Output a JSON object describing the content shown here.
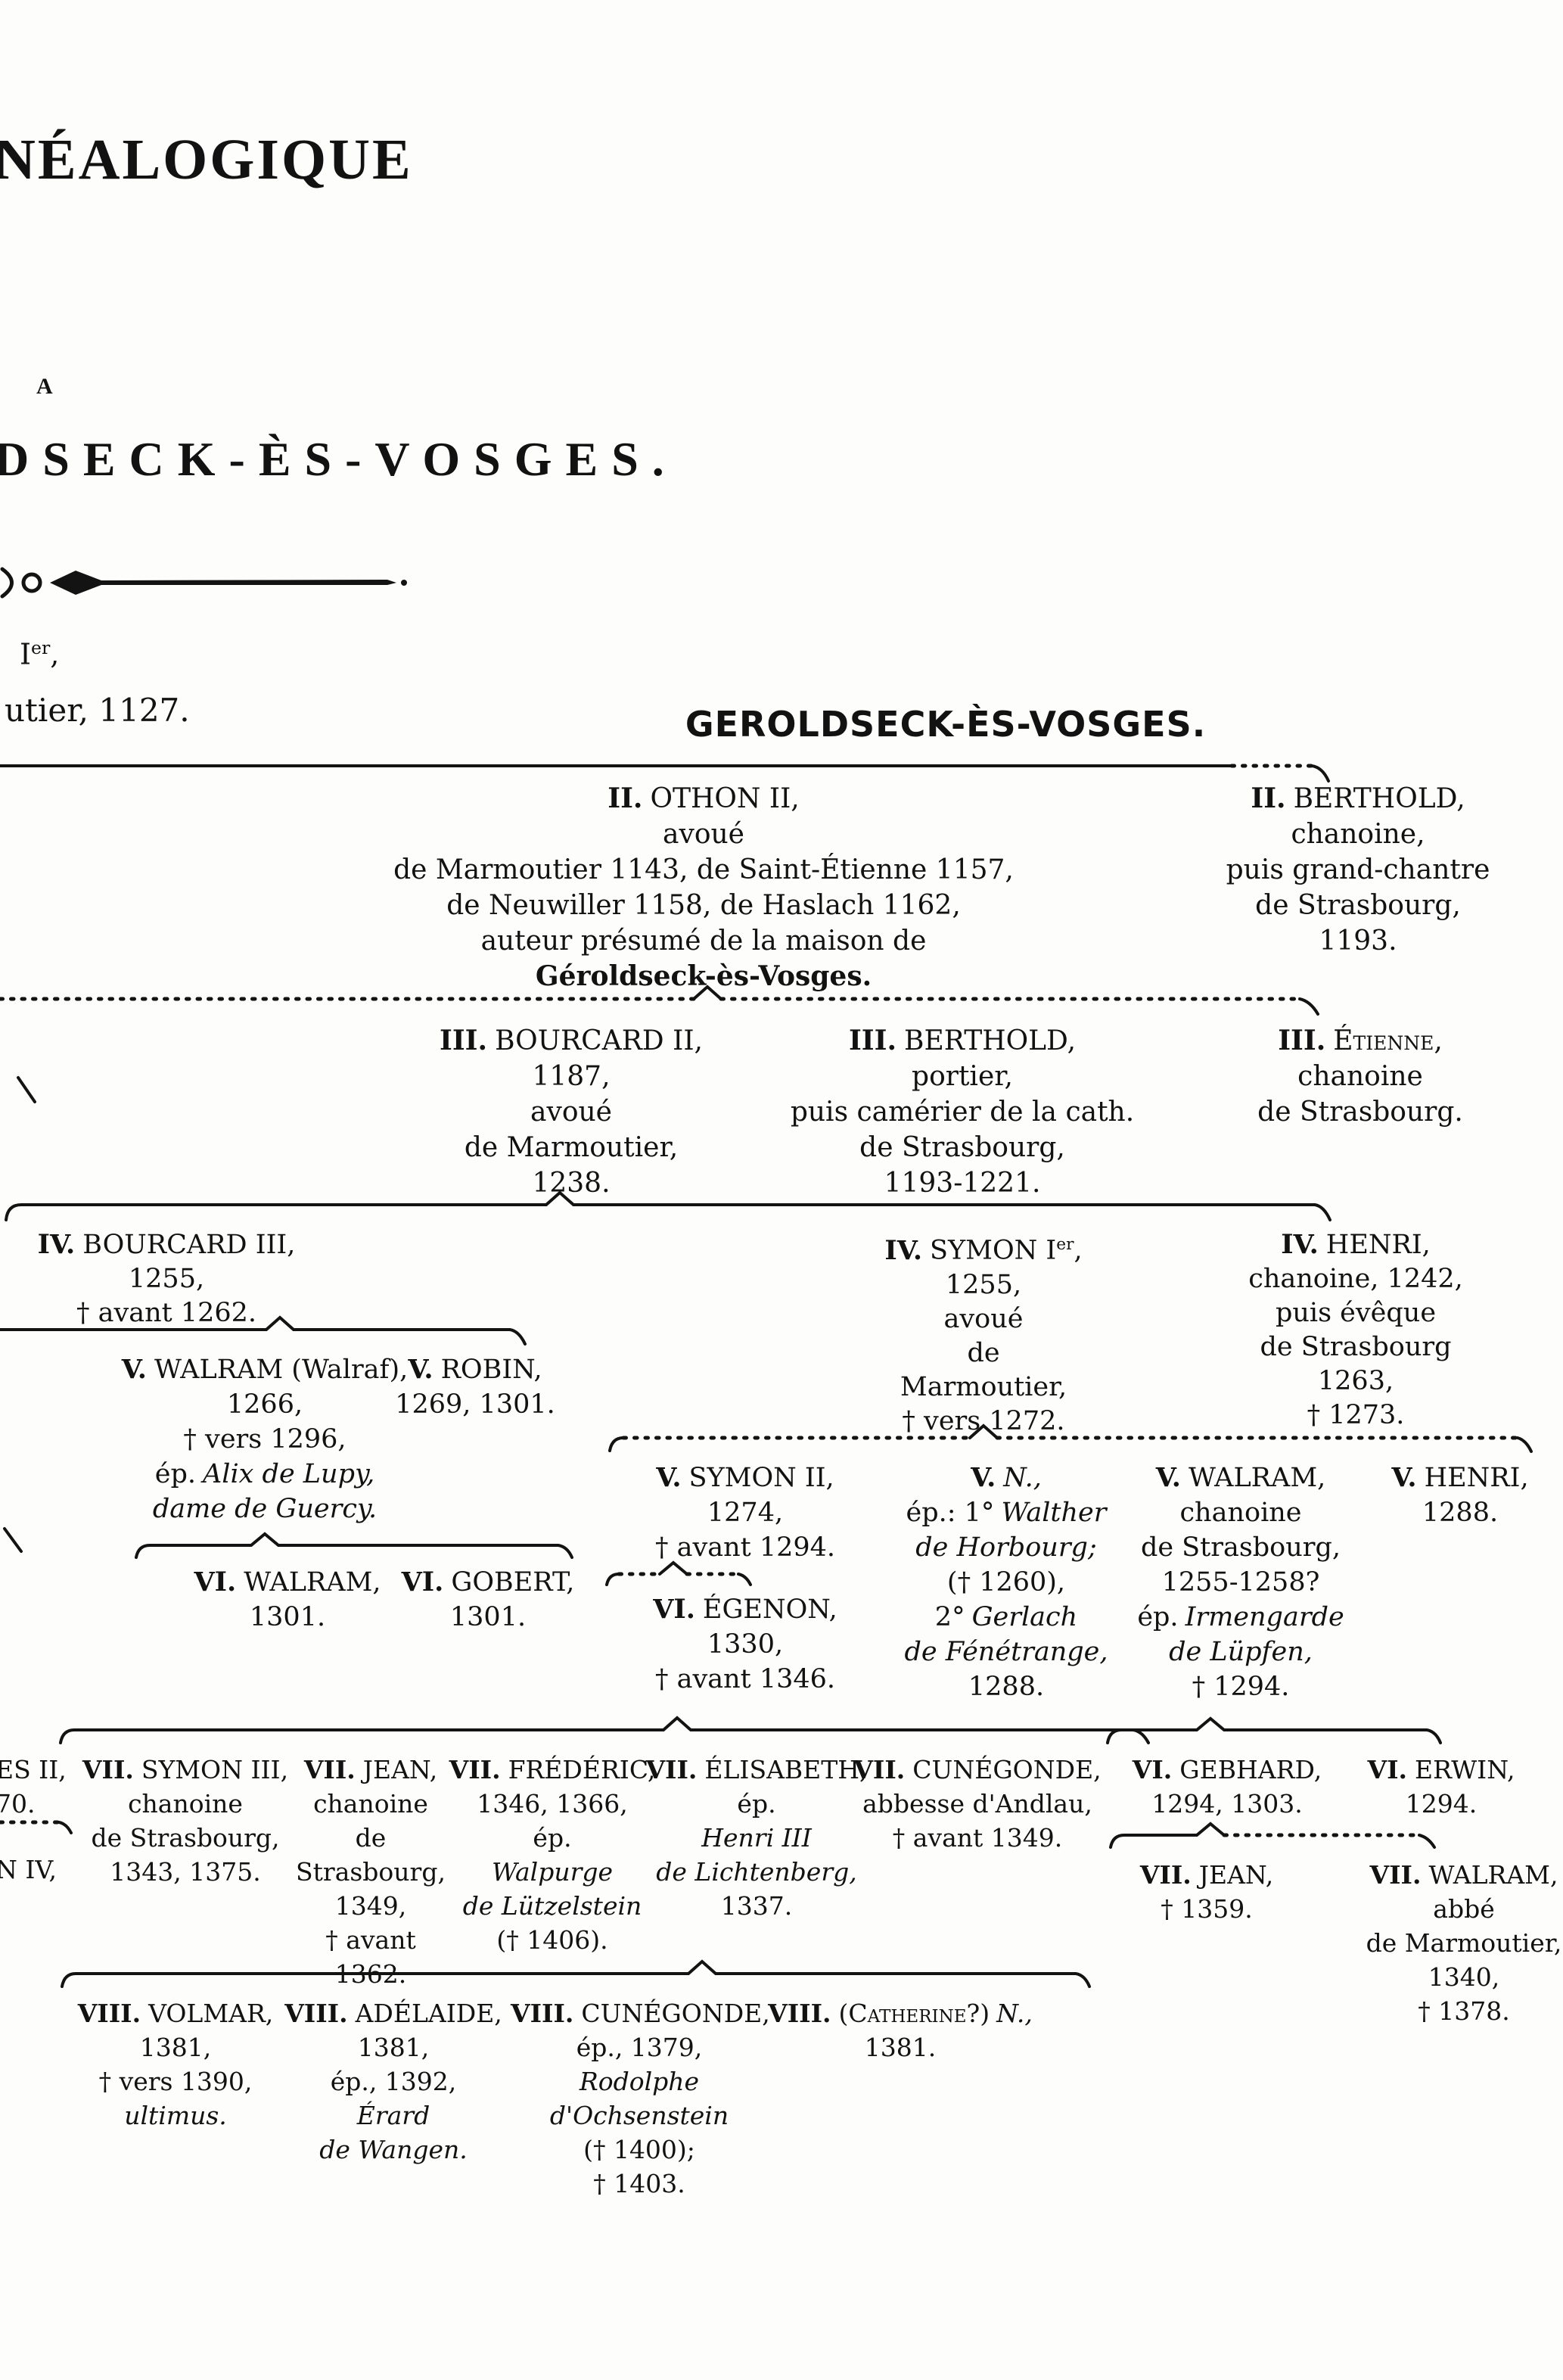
{
  "masthead": {
    "title_line1": "NÉALOGIQUE",
    "title_line2": "A",
    "title_line3": "DSECK-ÈS-VOSGES.",
    "note_base": "I",
    "note_sup": "er",
    "note_tail": ",",
    "note2": "utier, 1127.",
    "section_title": "GEROLDSECK-ÈS-VOSGES."
  },
  "fragments": {
    "g7_1": "ES II,",
    "g7_2": "70.",
    "g7_3": "N IV,"
  },
  "tree": {
    "othon": {
      "num": "II.",
      "name": "OTHON II,",
      "l1": "avoué",
      "l2": "de Marmoutier 1143, de Saint-Étienne 1157,",
      "l3": "de Neuwiller 1158, de Haslach 1162,",
      "l4": "auteur présumé de la maison de",
      "house": "Géroldseck-ès-Vosges."
    },
    "berthold2": {
      "num": "II.",
      "name": "BERTHOLD,",
      "l1": "chanoine,",
      "l2": "puis grand-chantre",
      "l3": "de Strasbourg,",
      "l4": "1193."
    },
    "bourcard2": {
      "num": "III.",
      "name": "BOURCARD II,",
      "l1": "1187,",
      "l2": "avoué",
      "l3": "de Marmoutier,",
      "l4": "1238."
    },
    "berthold3": {
      "num": "III.",
      "name": "BERTHOLD,",
      "l1": "portier,",
      "l2": "puis camérier de la cath.",
      "l3": "de Strasbourg,",
      "l4": "1193-1221."
    },
    "etienne": {
      "num": "III.",
      "name": "Étienne,",
      "l1": "chanoine",
      "l2": "de Strasbourg."
    },
    "bourcard3": {
      "num": "IV.",
      "name": "BOURCARD III,",
      "l1": "1255,",
      "l2": "† avant 1262."
    },
    "symon1": {
      "num": "IV.",
      "name_a": "SYMON I",
      "name_sup": "er",
      "name_b": ",",
      "l1": "1255,",
      "l2": "avoué",
      "l3": "de",
      "l4": "Marmoutier,",
      "l5": "† vers 1272."
    },
    "henri4": {
      "num": "IV.",
      "name": "HENRI,",
      "l1": "chanoine, 1242,",
      "l2": "puis évêque",
      "l3": "de Strasbourg",
      "l4": "1263,",
      "l5": "† 1273."
    },
    "walram5a": {
      "num": "V.",
      "name": "WALRAM (Walraf),",
      "l1": "1266,",
      "l2": "† vers 1296,",
      "ep": "ép.",
      "ep_name": "Alix de Lupy,",
      "l4": "dame de Guercy."
    },
    "robin": {
      "num": "V.",
      "name": "ROBIN,",
      "l1": "1269, 1301."
    },
    "symon2": {
      "num": "V.",
      "name": "SYMON II,",
      "l1": "1274,",
      "l2": "† avant 1294."
    },
    "n5": {
      "num": "V.",
      "name": "N.,",
      "ep": "ép.: 1°",
      "ep_name": "Walther",
      "l2": "de Horbourg;",
      "l3": "(† 1260),",
      "l4a": "2°",
      "l4b": "Gerlach",
      "l5": "de Fénétrange,",
      "l6": "1288."
    },
    "walram5b": {
      "num": "V.",
      "name": "WALRAM,",
      "l1": "chanoine",
      "l2": "de Strasbourg,",
      "l3": "1255-1258?",
      "ep": "ép.",
      "ep_name": "Irmengarde",
      "l5": "de Lüpfen,",
      "l6": "† 1294."
    },
    "henri5": {
      "num": "V.",
      "name": "HENRI,",
      "l1": "1288."
    },
    "walram6": {
      "num": "VI.",
      "name": "WALRAM,",
      "l1": "1301."
    },
    "gobert": {
      "num": "VI.",
      "name": "GOBERT,",
      "l1": "1301."
    },
    "egenon": {
      "num": "VI.",
      "name": "ÉGENON,",
      "l1": "1330,",
      "l2": "† avant 1346."
    },
    "gebhard": {
      "num": "VI.",
      "name": "GEBHARD,",
      "l1": "1294, 1303."
    },
    "erwin": {
      "num": "VI.",
      "name": "ERWIN,",
      "l1": "1294."
    },
    "symon3": {
      "num": "VII.",
      "name": "SYMON III,",
      "l1": "chanoine",
      "l2": "de Strasbourg,",
      "l3": "1343, 1375."
    },
    "jean7a": {
      "num": "VII.",
      "name": "JEAN,",
      "l1": "chanoine",
      "l2": "de",
      "l3": "Strasbourg,",
      "l4": "1349,",
      "l5": "† avant 1362."
    },
    "frederic": {
      "num": "VII.",
      "name": "FRÉDÉRIC,",
      "l1": "1346, 1366,",
      "l2": "ép.",
      "l3": "Walpurge",
      "l4": "de Lützelstein",
      "l5": "(† 1406)."
    },
    "elisabeth": {
      "num": "VII.",
      "name": "ÉLISABETH,",
      "l1": "ép.",
      "l2": "Henri III",
      "l3": "de Lichtenberg,",
      "l4": "1337."
    },
    "cunegonde7": {
      "num": "VII.",
      "name": "CUNÉGONDE,",
      "l1": "abbesse d'Andlau,",
      "l2": "† avant 1349."
    },
    "jean7b": {
      "num": "VII.",
      "name": "JEAN,",
      "l1": "† 1359."
    },
    "walram7": {
      "num": "VII.",
      "name": "WALRAM,",
      "l1": "abbé",
      "l2": "de Marmoutier,",
      "l3": "1340,",
      "l4": "† 1378."
    },
    "volmar": {
      "num": "VIII.",
      "name": "VOLMAR,",
      "l1": "1381,",
      "l2": "† vers 1390,",
      "l3": "ultimus."
    },
    "adelaide": {
      "num": "VIII.",
      "name": "ADÉLAIDE,",
      "l1": "1381,",
      "l2": "ép., 1392,",
      "l3": "Érard",
      "l4": "de Wangen."
    },
    "cunegonde8": {
      "num": "VIII.",
      "name": "CUNÉGONDE,",
      "l1": "ép., 1379,",
      "l2": "Rodolphe",
      "l3": "d'Ochsenstein",
      "l4": "(† 1400);",
      "l5": "† 1403."
    },
    "catherine": {
      "num": "VIII.",
      "name_sc": "(Catherine?)",
      "name_it": "N.,",
      "l1": "1381."
    }
  }
}
